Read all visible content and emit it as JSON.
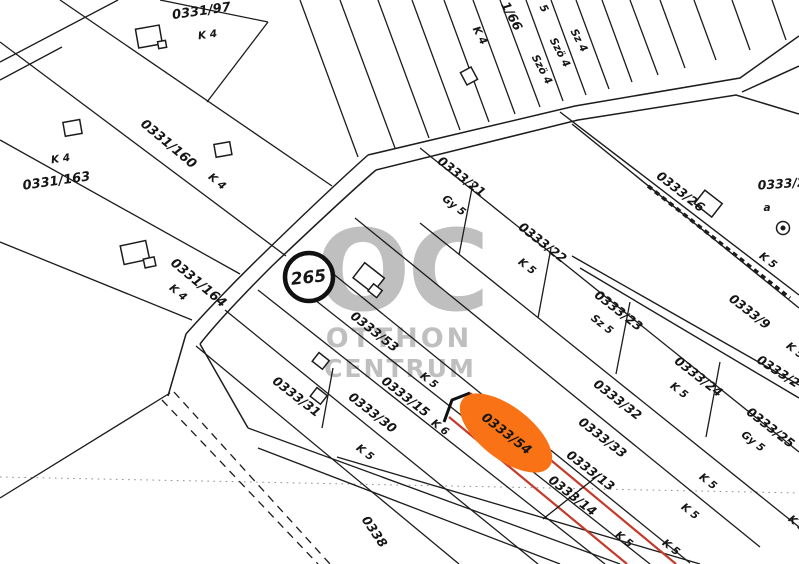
{
  "map": {
    "watermark": {
      "logo": "OC",
      "line1": "OTTHON",
      "line2": "CENTRUM",
      "color": "#b9b9b9"
    },
    "marker": {
      "value": "265"
    },
    "highlight": {
      "parcel_id": "0333/54",
      "fill": "#f97316",
      "outline_color": "#c43a2b",
      "replaced_parcel_id": "0333/14"
    },
    "parcels": [
      {
        "id": "0331/97",
        "grade": "K 4"
      },
      {
        "id": "0331/160",
        "grade": "K 4"
      },
      {
        "id": "0331/163",
        "grade": "K 4"
      },
      {
        "id": "0331/164",
        "grade": "K 4"
      },
      {
        "id": "0333/21",
        "grade": "Gy 5"
      },
      {
        "id": "0333/22",
        "grade": "K 5"
      },
      {
        "id": "0333/23",
        "grade": "Sz 5"
      },
      {
        "id": "0333/24",
        "grade": "K 5"
      },
      {
        "id": "0333/25",
        "grade": "Gy 5"
      },
      {
        "id": "0333/26",
        "grade": "K 5"
      },
      {
        "id": "0333/9"
      },
      {
        "id": "0333/2",
        "grade": "a"
      },
      {
        "id": "0333/2"
      },
      {
        "id": "0333/32"
      },
      {
        "id": "0333/33"
      },
      {
        "id": "0333/13"
      },
      {
        "id": "0333/14"
      },
      {
        "id": "0333/31"
      },
      {
        "id": "0333/30"
      },
      {
        "id": "0333/15",
        "grade": "K 6"
      },
      {
        "id": "0333/53",
        "grade": "K 5"
      },
      {
        "id": "0338"
      }
    ],
    "labels": [
      "K 4",
      "1/66",
      "5",
      "Szö 4",
      "Szö 4",
      "Sz 4",
      "K 5",
      "K 5",
      "K 5",
      "K 5",
      "K 5",
      "K 5",
      "K 5"
    ]
  }
}
